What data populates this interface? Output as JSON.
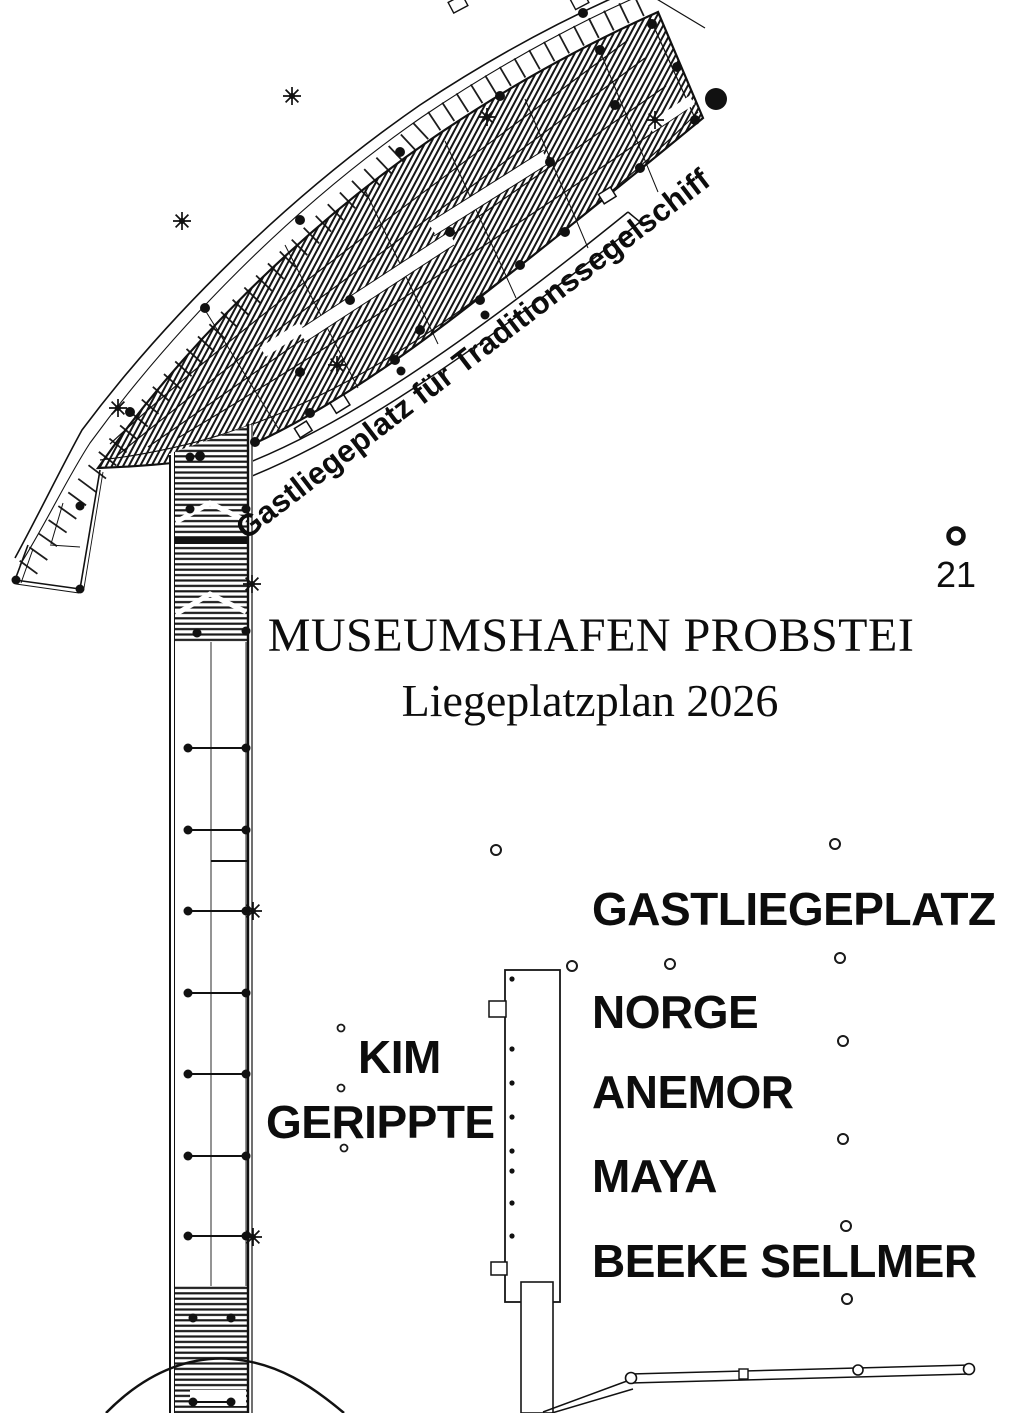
{
  "title": {
    "main": "MUSEUMSHAFEN PROBSTEI",
    "subtitle": "Liegeplatzplan 2026"
  },
  "annotations": {
    "traditional_sailing_berth": "Gastliegeplatz für Traditionssegelschiff",
    "guest_berth_heading": "GASTLIEGEPLATZ",
    "berth_number": "21"
  },
  "berths": {
    "kim": "KIM",
    "gerippte": "GERIPPTE",
    "norge": "NORGE",
    "anemor": "ANEMOR",
    "maya": "MAYA",
    "beeke_sellmer": "BEEKE SELLMER"
  },
  "markers": {
    "buoy": "filled-circle-marker",
    "berth_21_marker": "ring-marker",
    "mooring_rings": "small-ring-markers",
    "cleats": "dot-markers",
    "bollards": "star-markers"
  },
  "colors": {
    "ink": "#111111",
    "background": "#ffffff"
  }
}
